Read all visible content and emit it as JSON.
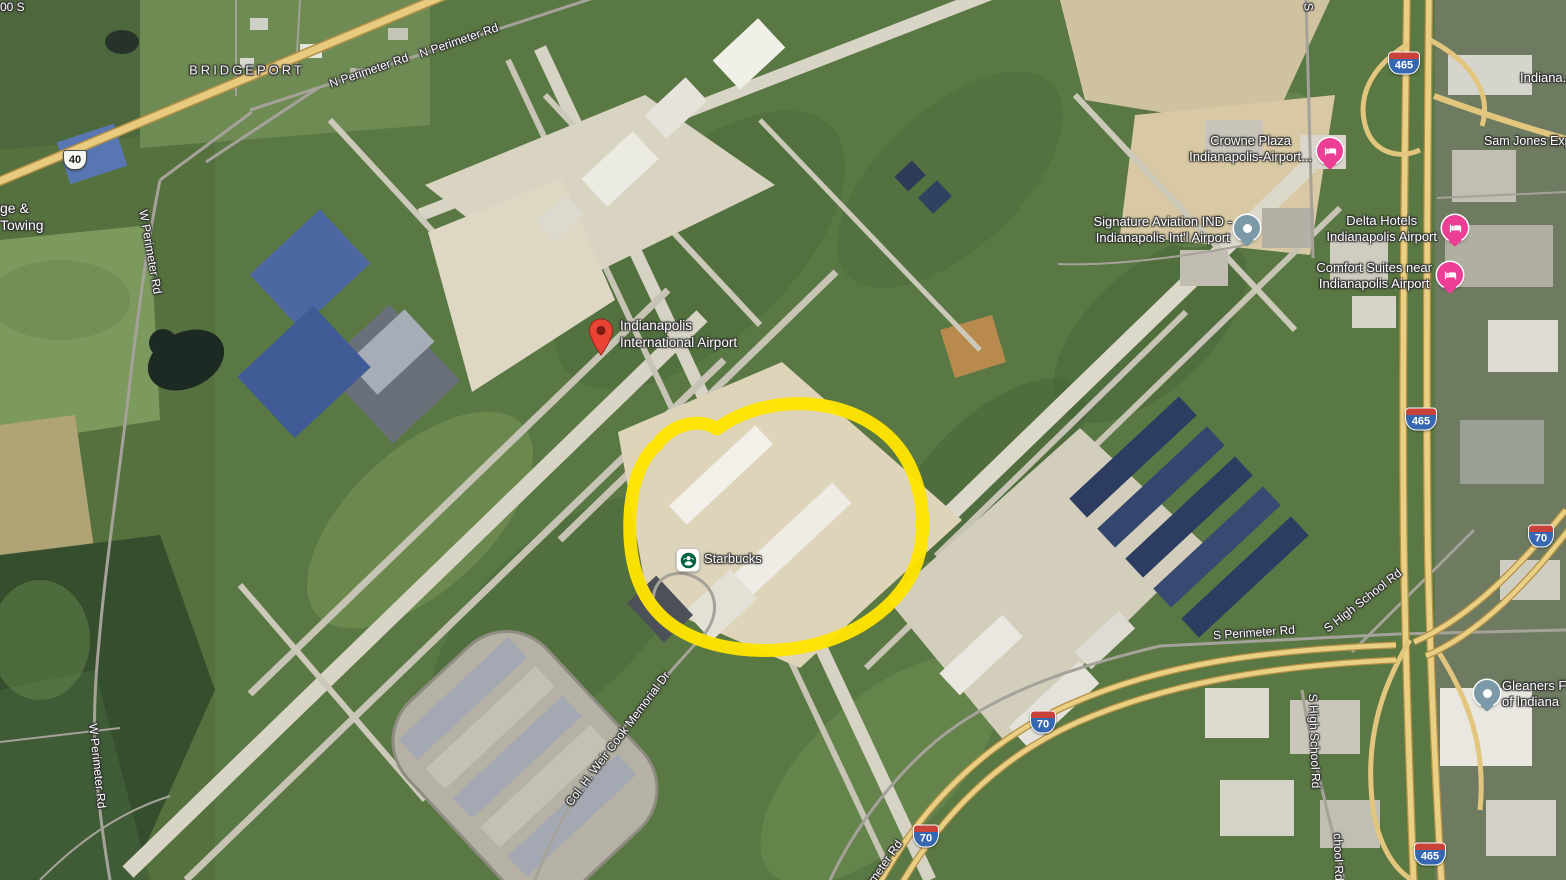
{
  "view": {
    "app": "satellite-map-view",
    "description": "Satellite view of Indianapolis International Airport with a hand-drawn yellow circle around the passenger terminal"
  },
  "annotation": {
    "shape": "hand-drawn-ellipse",
    "color": "#FFE400"
  },
  "labels": {
    "cut_top_left": "00 S",
    "bridgeport": "BRIDGEPORT",
    "n_perimeter_a": "N Perimeter Rd",
    "n_perimeter_b": "N Perimeter Rd",
    "w_perimeter_a": "W Perimeter Rd",
    "w_perimeter_b": "W Perimeter Rd",
    "towing_1": "ge &",
    "towing_2": "Towing",
    "airport_1": "Indianapolis",
    "airport_2": "International Airport",
    "starbucks": "Starbucks",
    "crowne_1": "Crowne Plaza",
    "crowne_2": "Indianapolis-Airport...",
    "signature_1": "Signature Aviation IND -",
    "signature_2": "Indianapolis Int'l Airport",
    "delta_1": "Delta Hotels",
    "delta_2": "Indianapolis Airport",
    "comfort_1": "Comfort Suites near",
    "comfort_2": "Indianapolis Airport",
    "sam_jones": "Sam Jones Exp...",
    "indiana_cut": "Indiana...",
    "s_cut": "S",
    "s_perimeter": "S Perimeter Rd",
    "s_high_school_diag": "S High School Rd",
    "s_high_school_vert": "S High School Rd",
    "s_high_school_cut": "chool Rd",
    "perimeter_cut": "imeter Rd",
    "weir_cook": "Col. H. Weir Cook Memorial Dr",
    "gleaners_1": "Gleaners F",
    "gleaners_2": "of Indiana"
  },
  "shields": {
    "us40": "40",
    "i465_top": "465",
    "i465_mid": "465",
    "i465_bottom": "465",
    "i70_ne": "70",
    "i70_arc": "70",
    "i70_south": "70"
  },
  "colors": {
    "annotation_yellow": "#FFE400",
    "place_pin_red": "#EA4335",
    "hotel_pin_pink": "#ED3E96",
    "poi_pin_slate": "#7B99A7",
    "highway_fill": "#EAD084",
    "label_text": "#FDFDFD",
    "label_halo": "#333333"
  }
}
